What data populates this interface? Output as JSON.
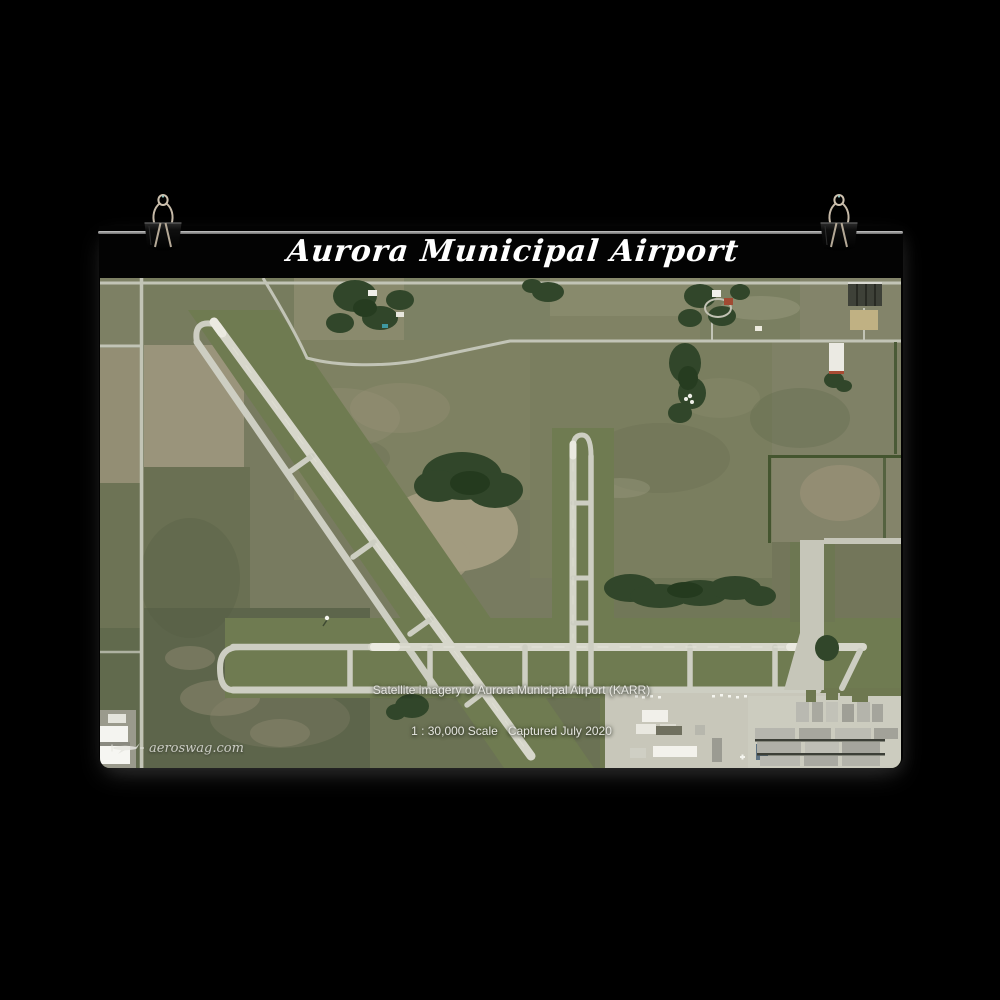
{
  "poster": {
    "title": "Aurora Municipal Airport",
    "caption": {
      "line1": "Satellite imagery of Aurora Municipal Airport (KARR)",
      "line2": "1 : 30,000 Scale   Captured July 2020"
    },
    "watermark_text": "aeroswag.com",
    "airport_code": "KARR",
    "scale": "1 : 30,000",
    "captured": "July 2020"
  },
  "colors": {
    "background": "#000000",
    "title_text": "#ffffff",
    "caption_text": "#e6e6e0",
    "wire": "#8d8d8d",
    "clip_body": "#0e0e0e",
    "clip_handle": "#c6baa8",
    "farmland_olive": "#7a7e62",
    "farmland_tan": "#9a947b",
    "airfield_grass": "#6f7b51",
    "pavement": "#cdcec2",
    "runway": "#d7d7cb",
    "forest": "#31462a",
    "building_white": "#f2f1eb",
    "hangar_gray": "#b0b0a7"
  }
}
